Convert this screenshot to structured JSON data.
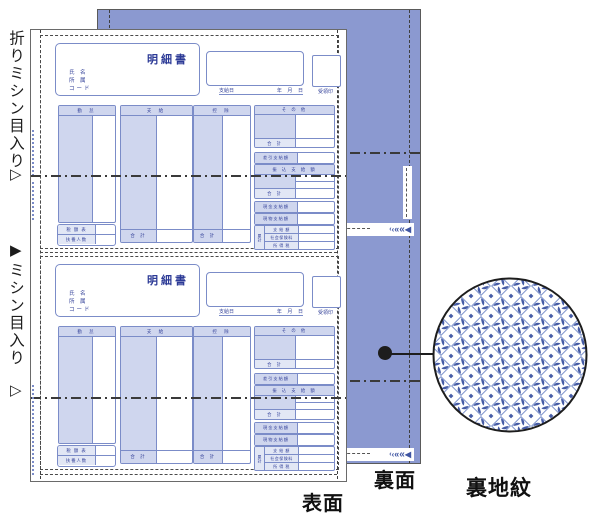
{
  "illustration": {
    "annotations": {
      "fold_perforation": "折りミシン目入り",
      "fold_marker": "▷",
      "cut_marker": "▶",
      "cut_perforation": "ミシン目入り",
      "front_side": "表面",
      "back_side": "裏面",
      "back_pattern": "裏地紋"
    },
    "colors": {
      "back_sheet": "#8b99d0",
      "form_line": "#7b8cc8",
      "form_shade": "#cfd6ee",
      "form_text": "#35439a",
      "pattern_blue": "#465ca6"
    },
    "tear_chevrons": [
      "‹",
      "‹",
      "«",
      "«",
      "◀"
    ]
  },
  "coupon": {
    "title": "明細書",
    "name_label": "氏 名",
    "dept_label": "所 属",
    "code_label": "コード",
    "pay_date_label": "支給日",
    "date_units": "年    月    日",
    "stamp_label": "受領印",
    "column_headers": [
      "勤 怠",
      "支 給",
      "控 除",
      "そ の 他"
    ],
    "tax_table_label": "税 額 表",
    "dependents_label": "扶養人数",
    "total_label": "合  計",
    "net_pay_label": "差引支給額",
    "transfer_header": "振 込 支 給 額",
    "cash_pay_label": "現金支給額",
    "inkind_pay_label": "現物支給額",
    "cumulative_label": "累計",
    "cumulative_rows": [
      "支 給 額",
      "社会保険料",
      "所 得 税"
    ]
  }
}
